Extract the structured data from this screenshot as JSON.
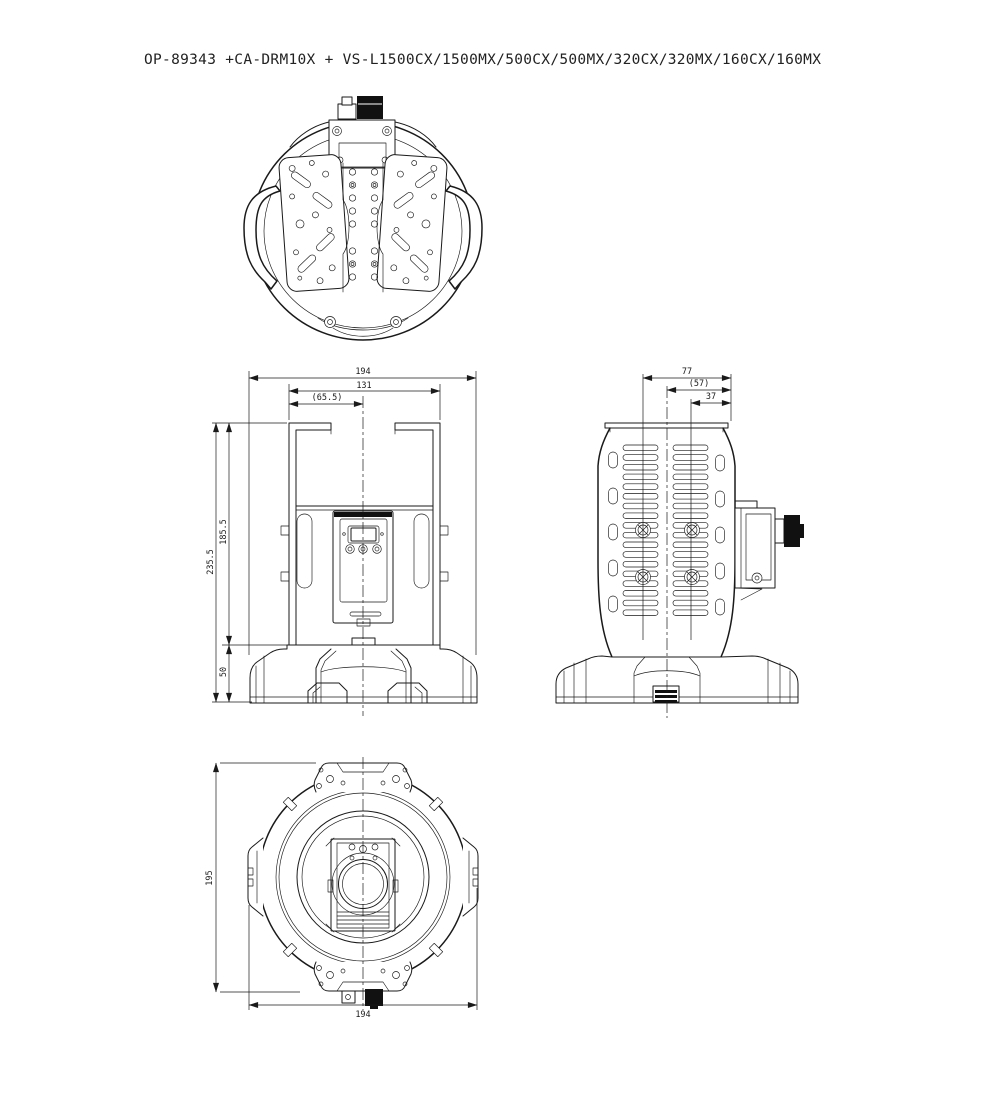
{
  "title": "OP-89343 +CA-DRM10X + VS-L1500CX/1500MX/500CX/500MX/320CX/320MX/160CX/160MX",
  "colors": {
    "line": "#1a1a1a",
    "background": "#ffffff",
    "connector_fill": "#111111"
  },
  "dims": {
    "front": {
      "overall_width": "194",
      "bracket_width": "131",
      "center_offset": "(65.5)",
      "overall_height": "235.5",
      "body_height": "185.5",
      "base_height": "50"
    },
    "side": {
      "mount_pitch": "77",
      "center_offset": "(57)",
      "hole_offset": "37"
    },
    "bottom": {
      "overall_depth": "195",
      "overall_width": "194"
    }
  }
}
